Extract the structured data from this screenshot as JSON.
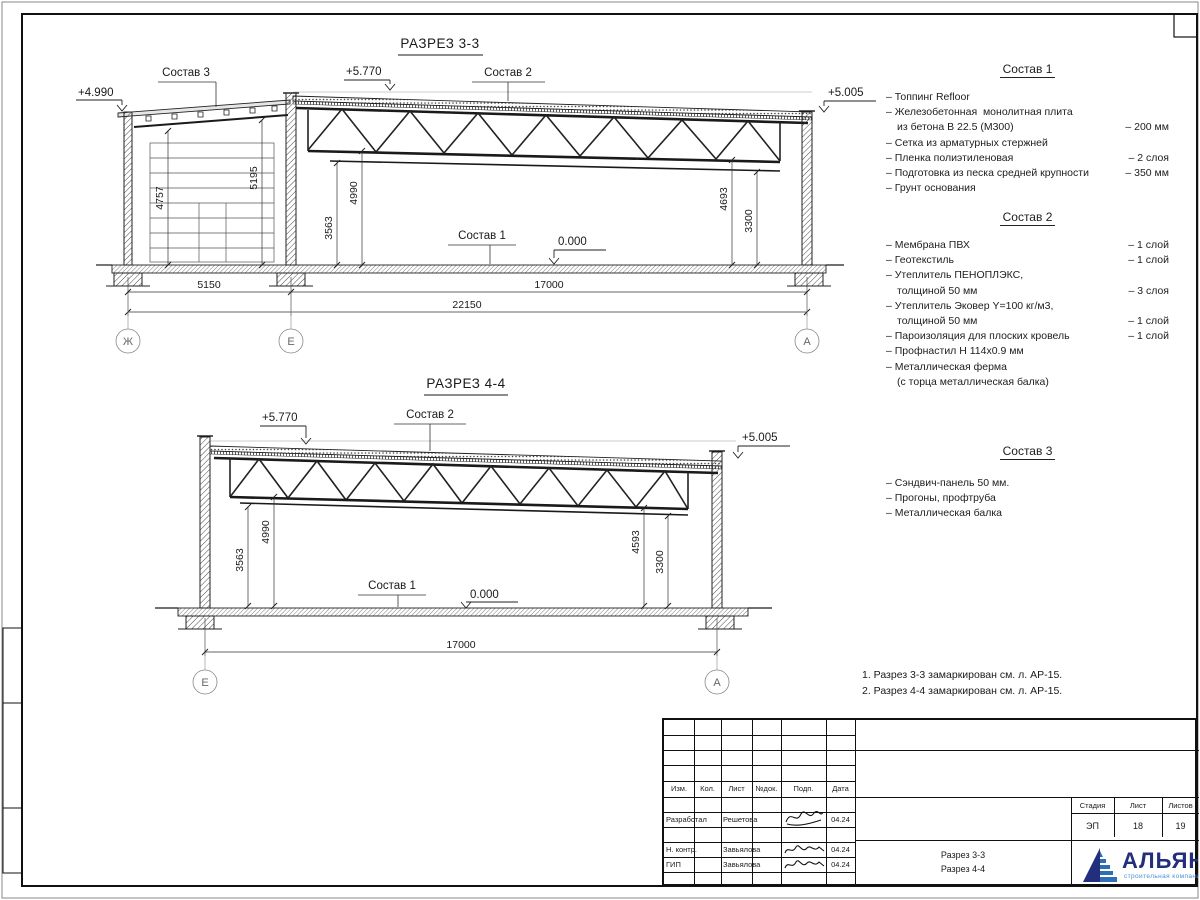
{
  "titles": {
    "section1": "РАЗРЕЗ 3-3",
    "section2": "РАЗРЕЗ 4-4"
  },
  "levels": {
    "annex_roof": "+4.990",
    "roof_high": "+5.770",
    "roof_low": "+5.005",
    "floor": "0.000"
  },
  "dims": {
    "d4757": "4757",
    "d5195": "5195",
    "d3563": "3563",
    "d4990": "4990",
    "d4693": "4693",
    "d3300": "3300",
    "d4593": "4593",
    "d5150": "5150",
    "d17000": "17000",
    "d22150": "22150"
  },
  "axes": {
    "zh": "Ж",
    "e": "Е",
    "a": "А"
  },
  "callouts": {
    "sostav1": "Состав 1",
    "sostav2": "Состав 2",
    "sostav3": "Состав 3"
  },
  "compositions": [
    {
      "title": "Состав 1",
      "rows": [
        {
          "text": "– Топпинг Refloor",
          "value": ""
        },
        {
          "text": "– Железобетонная  монолитная плита",
          "value": ""
        },
        {
          "text": "из бетона В 22.5 (М300)",
          "value": "– 200 мм"
        },
        {
          "text": "– Сетка из арматурных стержней",
          "value": ""
        },
        {
          "text": "– Пленка полиэтиленовая",
          "value": "– 2 слоя"
        },
        {
          "text": "– Подготовка из песка средней крупности",
          "value": "– 350 мм"
        },
        {
          "text": "– Грунт основания",
          "value": ""
        }
      ]
    },
    {
      "title": "Состав 2",
      "rows": [
        {
          "text": "– Мембрана ПВХ",
          "value": "– 1 слой"
        },
        {
          "text": "– Геотекстиль",
          "value": "– 1 слой"
        },
        {
          "text": "– Утеплитель ПЕНОПЛЭКС,",
          "value": ""
        },
        {
          "text": "толщиной 50 мм",
          "value": "– 3 слоя"
        },
        {
          "text": "– Утеплитель Эковер Y=100 кг/м3,",
          "value": ""
        },
        {
          "text": "толщиной 50 мм",
          "value": "– 1 слой"
        },
        {
          "text": "– Пароизоляция для плоских кровель",
          "value": "– 1 слой"
        },
        {
          "text": "– Профнастил Н 114х0.9 мм",
          "value": ""
        },
        {
          "text": "– Металлическая ферма",
          "value": ""
        },
        {
          "text": "(с торца металлическая балка)",
          "value": ""
        }
      ]
    },
    {
      "title": "Состав 3",
      "rows": [
        {
          "text": "– Сэндвич-панель 50 мм.",
          "value": ""
        },
        {
          "text": "– Прогоны, профтруба",
          "value": ""
        },
        {
          "text": "– Металлическая балка",
          "value": ""
        }
      ]
    }
  ],
  "notes": [
    "1. Разрез 3-3 замаркирован см. л. АР-15.",
    "2. Разрез 4-4 замаркирован см. л. АР-15."
  ],
  "titleblock": {
    "headers": [
      "Изм.",
      "Кол.",
      "Лист",
      "№док.",
      "Подп.",
      "Дата"
    ],
    "rows": [
      {
        "role": "Разработал",
        "name": "Решетова",
        "date": "04.24"
      },
      {
        "role": "Н. контр.",
        "name": "Завьялова",
        "date": "04.24"
      },
      {
        "role": "ГИП",
        "name": "Завьялова",
        "date": "04.24"
      }
    ],
    "doc_name_line1": "Разрез 3-3",
    "doc_name_line2": "Разрез 4-4",
    "stage_label": "Стадия",
    "list_label": "Лист",
    "listov_label": "Листов",
    "stage": "ЭП",
    "list": "18",
    "listov": "19",
    "company": "АЛЬЯНС",
    "company_sub": "строительная компания"
  },
  "colors": {
    "logo_dark": "#232e7d",
    "logo_light": "#2e6fb5",
    "line": "#1a1a1a"
  }
}
